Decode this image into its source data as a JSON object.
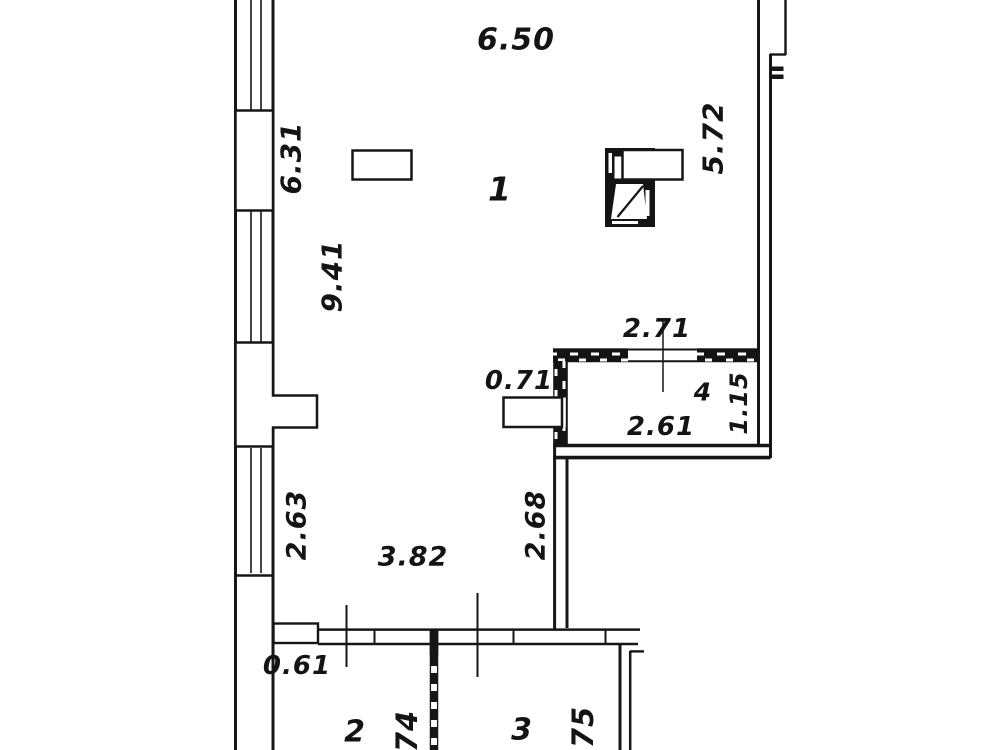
{
  "floorplan": {
    "colors": {
      "background": "#ffffff",
      "line": "#161616"
    },
    "dimensions": {
      "top_width": "6.50",
      "left_wall_upper": "6.31",
      "left_wall_middle": "9.41",
      "right_wall": "5.72",
      "room4_top_width": "2.71",
      "pier_width": "0.71",
      "room4_width": "2.61",
      "room4_depth": "1.15",
      "left_window_lower": "2.63",
      "lower_wall_height": "2.68",
      "lower_room_width": "3.82",
      "bottom_step": "0.61"
    },
    "rooms": {
      "room1": "1",
      "room2": "2",
      "room3": "3",
      "room4": "4"
    },
    "codes": {
      "balcony2": "74",
      "balcony3": "75"
    }
  }
}
